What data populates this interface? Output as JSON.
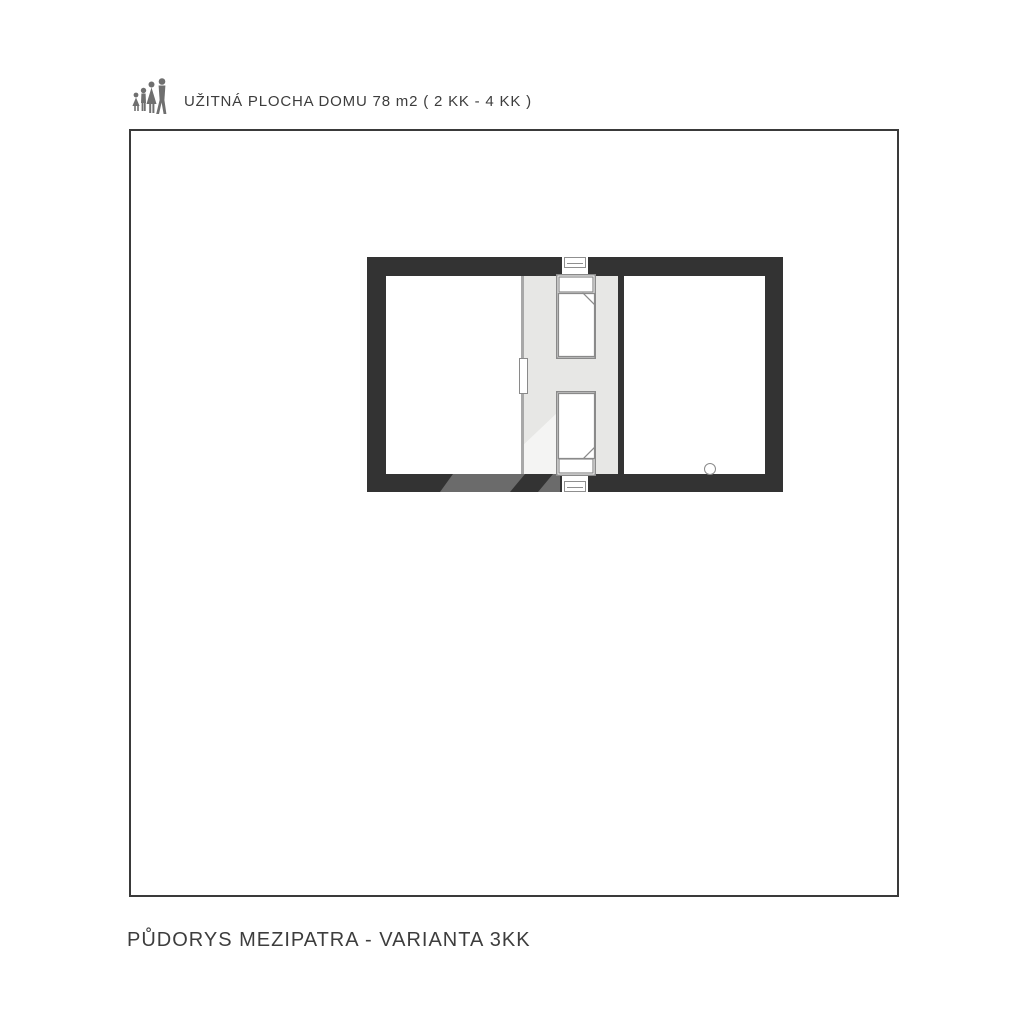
{
  "header": {
    "title": "UŽITNÁ PLOCHA DOMU 78 m2 ( 2 KK - 4 KK )",
    "icon": "family-icon"
  },
  "footer": {
    "caption": "PŮDORYS MEZIPATRA - VARIANTA 3KK"
  },
  "plan": {
    "rooms": [
      "left-room",
      "landing-with-beds",
      "right-room"
    ],
    "features": [
      "window-top",
      "window-bottom",
      "bed-top",
      "bed-bottom",
      "door-leaf",
      "drain-circle"
    ]
  },
  "colors": {
    "wall": "#333333",
    "landing": "#e7e7e5",
    "segment": "#6b6b6b",
    "outline": "#8a8a8a",
    "text": "#3d3d3d",
    "icon": "#6f6f6f"
  }
}
